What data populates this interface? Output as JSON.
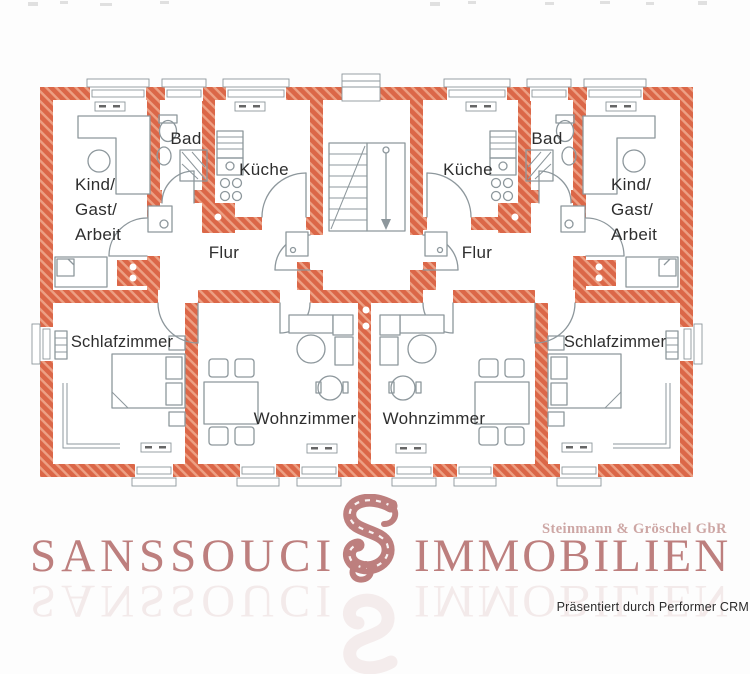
{
  "floorplan": {
    "wall_color": "#db6748",
    "wall_hatch_color": "#eda084",
    "line_color": "#8d979c",
    "label_color": "#2e2e2e",
    "rooms": {
      "kind_gast_arbeit": [
        "Kind/",
        "Gast/",
        "Arbeit"
      ],
      "bad": "Bad",
      "kueche": "Küche",
      "flur": "Flur",
      "schlafzimmer": "Schlafzimmer",
      "wohnzimmer": "Wohnzimmer"
    }
  },
  "branding": {
    "name_left": "SANSSOUCI",
    "name_right": "IMMOBILIEN",
    "partner": "Steinmann & Gröschel GbR",
    "text_color": "#bd7f7e",
    "partner_color": "#cda6a4"
  },
  "footer": {
    "credit": "Präsentiert durch Performer CRM",
    "credit_color": "#2b2b2b"
  }
}
